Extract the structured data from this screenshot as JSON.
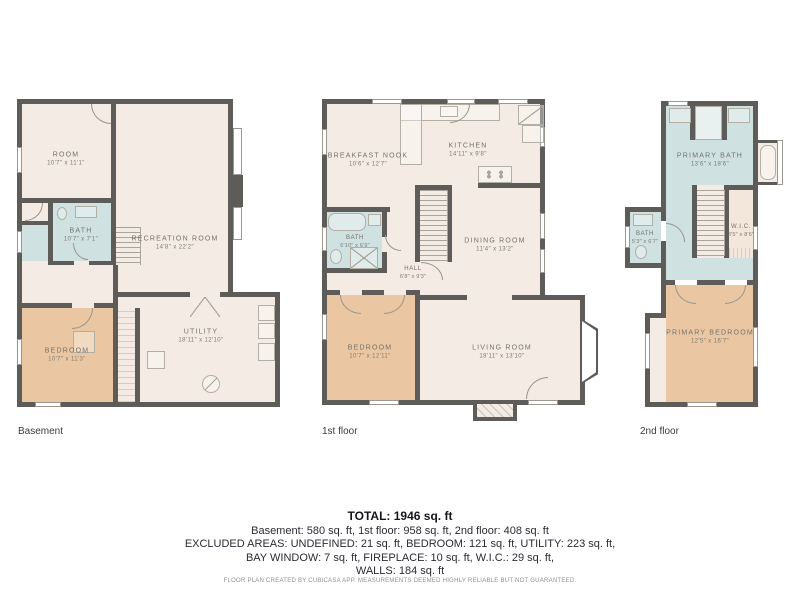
{
  "plans": [
    {
      "floor_label": "Basement",
      "rooms": [
        {
          "name": "ROOM",
          "dims": "10'7\" x 11'1\""
        },
        {
          "name": "RECREATION ROOM",
          "dims": "14'8\" x 22'2\""
        },
        {
          "name": "BATH",
          "dims": "10'7\" x 7'1\""
        },
        {
          "name": "BEDROOM",
          "dims": "10'7\" x 11'3\""
        },
        {
          "name": "UTILITY",
          "dims": "18'11\" x 12'10\""
        }
      ]
    },
    {
      "floor_label": "1st floor",
      "rooms": [
        {
          "name": "BREAKFAST NOOK",
          "dims": "10'6\" x 12'7\""
        },
        {
          "name": "KITCHEN",
          "dims": "14'11\" x 9'8\""
        },
        {
          "name": "DINING ROOM",
          "dims": "11'4\" x 13'2\""
        },
        {
          "name": "BATH",
          "dims": "6'10\" x 6'9\""
        },
        {
          "name": "HALL",
          "dims": "6'8\" x 9'3\""
        },
        {
          "name": "BEDROOM",
          "dims": "10'7\" x 12'11\""
        },
        {
          "name": "LIVING ROOM",
          "dims": "18'11\" x 13'10\""
        }
      ]
    },
    {
      "floor_label": "2nd floor",
      "rooms": [
        {
          "name": "PRIMARY BATH",
          "dims": "13'6\" x 18'6\""
        },
        {
          "name": "BATH",
          "dims": "5'3\" x 6'7\""
        },
        {
          "name": "W.I.C.",
          "dims": "3'5\" x 8'6\""
        },
        {
          "name": "PRIMARY BEDROOM",
          "dims": "12'5\" x 16'7\""
        }
      ]
    }
  ],
  "summary": {
    "total": "TOTAL: 1946 sq. ft",
    "line1": "Basement: 580 sq. ft, 1st floor: 958 sq. ft, 2nd floor: 408 sq. ft",
    "line2": "EXCLUDED AREAS: UNDEFINED: 21 sq. ft, BEDROOM: 121 sq. ft, UTILITY: 223 sq. ft,",
    "line3": "BAY WINDOW: 7 sq. ft, FIREPLACE: 10 sq. ft, W.I.C.: 29 sq. ft,",
    "line4": "WALLS: 184 sq. ft"
  },
  "disclaimer": "FLOOR PLAN CREATED BY CUBICASA APP. MEASUREMENTS DEEMED HIGHLY RELIABLE BUT NOT GUARANTEED.",
  "colors": {
    "wall": "#5d5c59",
    "floor": "#f4ebe4",
    "bedroom_fill": "#eac7a2",
    "bath_fill": "#cfe1e1",
    "wic_fill": "#f3e6db",
    "label_text": "#74726b",
    "summary_text": "#2b2b33",
    "disclaimer_text": "#8f8f8f"
  }
}
